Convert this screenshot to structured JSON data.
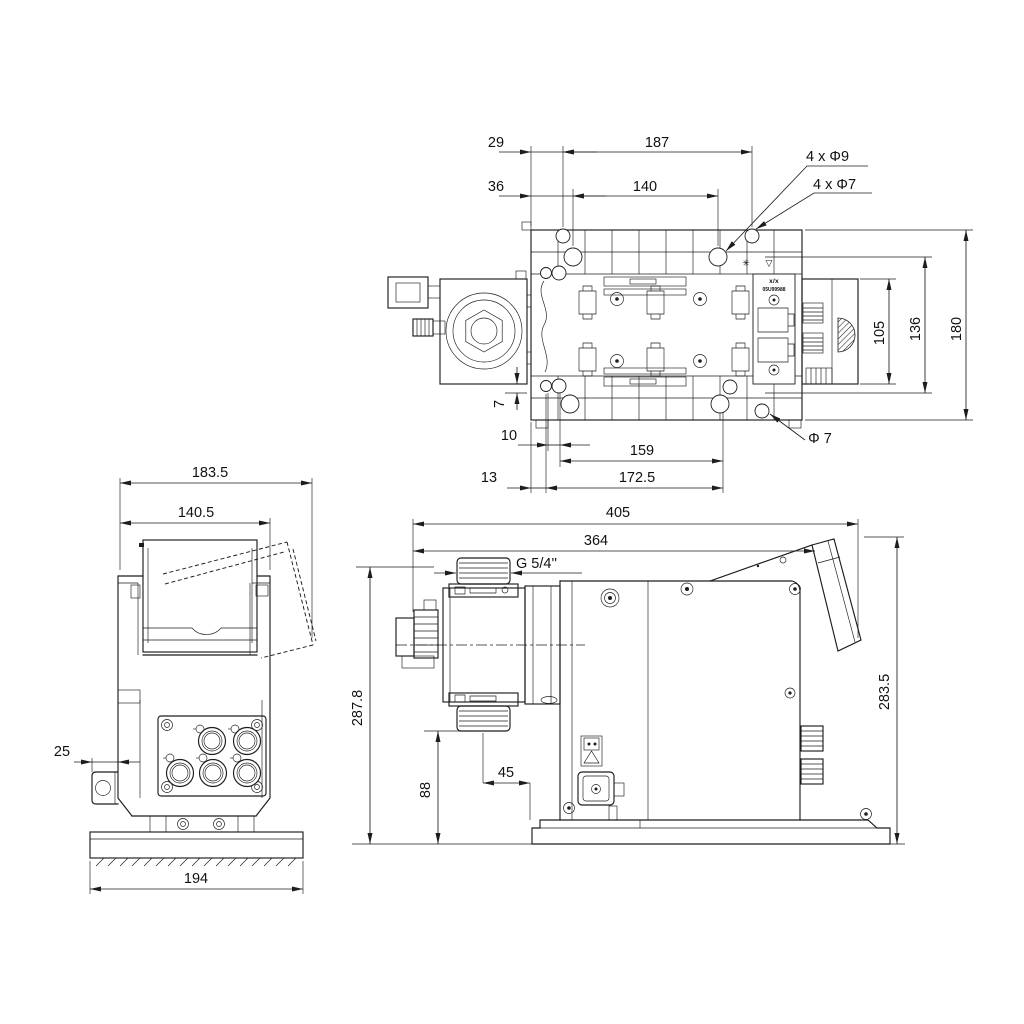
{
  "colors": {
    "background": "#ffffff",
    "line": "#1d1d1d"
  },
  "top_view": {
    "dim_29": "29",
    "dim_187": "187",
    "dim_36": "36",
    "dim_140": "140",
    "holes_label_1": "4 x Φ9",
    "holes_label_2": "4 x Φ7",
    "dim_105": "105",
    "dim_136": "136",
    "dim_180": "180",
    "dim_7": "7",
    "dim_10": "10",
    "dim_159": "159",
    "dia_7": "Φ 7",
    "dim_13": "13",
    "dim_172_5": "172.5",
    "plate_label_1": "x/x",
    "plate_label_2": "05U99988",
    "plate_icon_gear": "✳",
    "plate_icon_warning": "▽"
  },
  "front_view": {
    "dim_183_5": "183.5",
    "dim_140_5": "140.5",
    "dim_25": "25",
    "dim_194": "194"
  },
  "side_view": {
    "dim_405": "405",
    "dim_364": "364",
    "thread_label": "G 5/4''",
    "dim_287_8": "287.8",
    "dim_88": "88",
    "dim_45": "45",
    "dim_283_5": "283.5"
  }
}
